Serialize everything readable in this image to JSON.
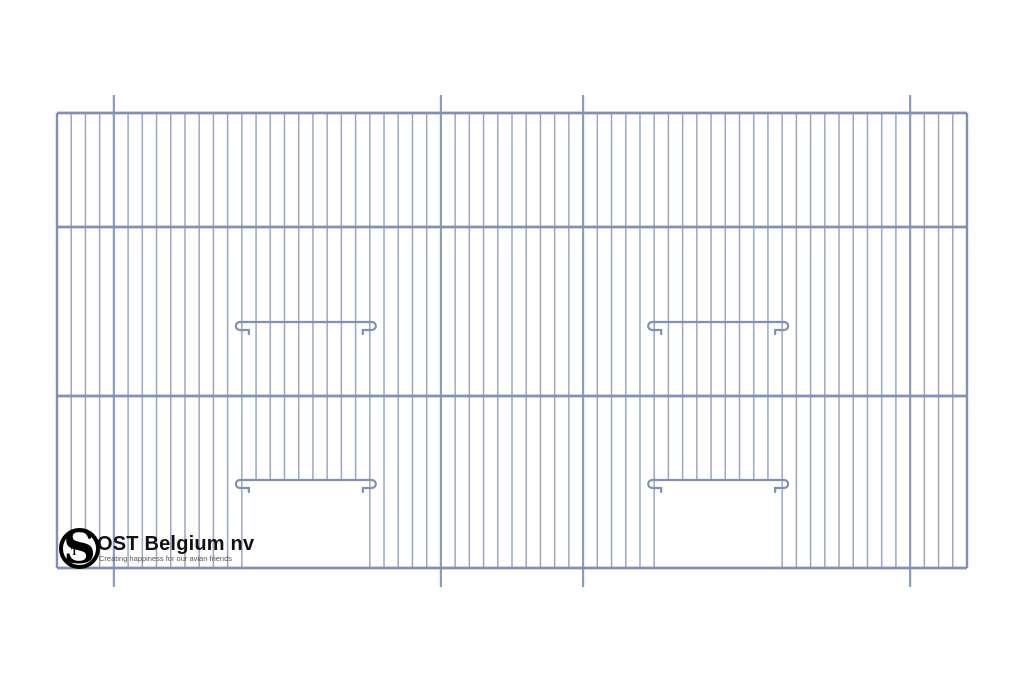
{
  "page": {
    "background_color": "#ffffff"
  },
  "logo": {
    "monogram_letter": "S",
    "monogram_sub_letter": "T",
    "company_name": "OST Belgium nv",
    "tagline": "Creating happiness for our avian friends",
    "monogram_color": "#000000",
    "company_color": "#111111",
    "tagline_color": "#555555"
  },
  "drawing": {
    "frame": {
      "x_left": 57,
      "x_right": 967,
      "y_top": 113,
      "y_bottom": 568
    },
    "horizontal_bar_ys": [
      113,
      227,
      396,
      568
    ],
    "wires": {
      "count": 65
    },
    "posts": {
      "indices": [
        4,
        27,
        37,
        60
      ],
      "y_top": 95,
      "y_bottom": 587
    },
    "doors": [
      {
        "left_wire_index": 13,
        "right_wire_index": 22
      },
      {
        "left_wire_index": 42,
        "right_wire_index": 51
      }
    ],
    "perch_rail_y": 322,
    "door_rail_y": 480,
    "colors": {
      "wire": "#9aa6c6",
      "bar": "#8191b5",
      "post": "#8d9bc0",
      "rail": "#8191b5"
    }
  }
}
